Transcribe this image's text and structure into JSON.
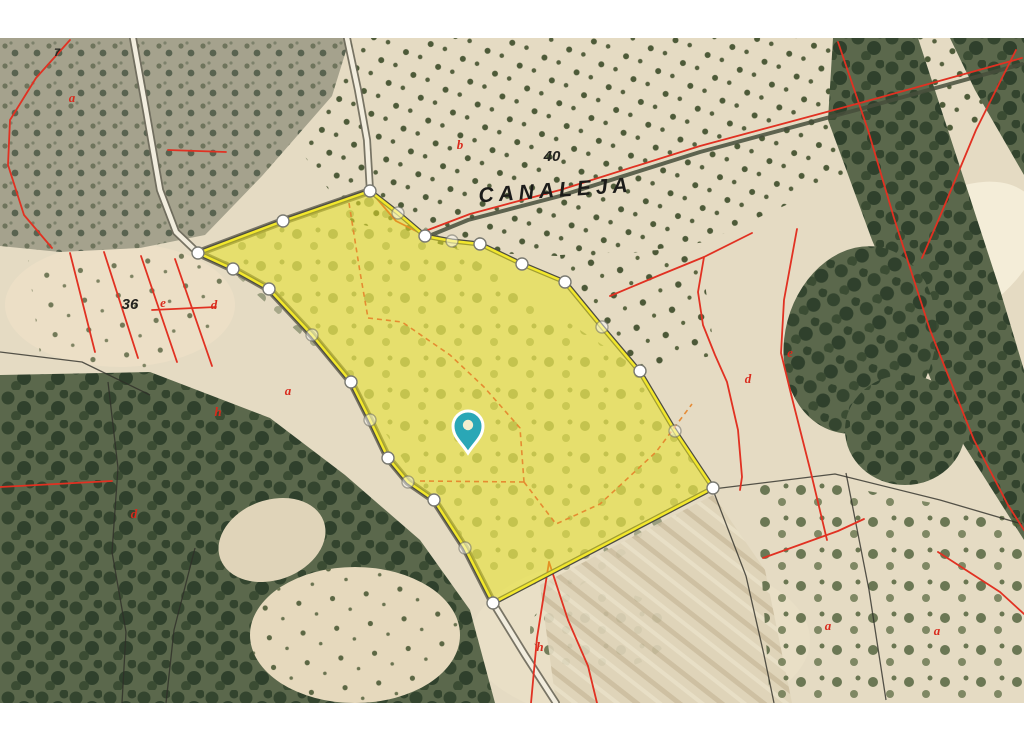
{
  "map": {
    "type_label": "aerial-cadastral-parcel-map",
    "colors": {
      "base": "#e5dbc3",
      "red_line": "#e13122",
      "orange_line": "#e5872e",
      "black_line": "#2e2e28",
      "track": "#474e3b",
      "road_casing": "#6b685a",
      "road_fill": "#f2edde",
      "parcel_fill": "#e8e226",
      "parcel_edge": "#f2e72c",
      "parcel_outline": "#4c4c41",
      "pin": "#2aa7b6",
      "pin_hole": "#f3efcf",
      "label_black": "#1c1c1a",
      "label_red": "#d92a1c"
    },
    "labels": {
      "toponym": {
        "text": "CANALEJA",
        "x": 556,
        "y": 197,
        "rotate": -4
      },
      "numbers": [
        {
          "text": "40",
          "x": 552,
          "y": 161
        },
        {
          "text": "36",
          "x": 130,
          "y": 309
        },
        {
          "text": "7",
          "x": 57,
          "y": 56
        }
      ],
      "letters": [
        {
          "text": "a",
          "x": 72,
          "y": 102
        },
        {
          "text": "b",
          "x": 460,
          "y": 149
        },
        {
          "text": "e",
          "x": 163,
          "y": 307
        },
        {
          "text": "d",
          "x": 214,
          "y": 309
        },
        {
          "text": "h",
          "x": 218,
          "y": 416
        },
        {
          "text": "a",
          "x": 288,
          "y": 395
        },
        {
          "text": "d",
          "x": 134,
          "y": 518
        },
        {
          "text": "h",
          "x": 540,
          "y": 651
        },
        {
          "text": "d",
          "x": 748,
          "y": 383
        },
        {
          "text": "e",
          "x": 790,
          "y": 357
        },
        {
          "text": "a",
          "x": 828,
          "y": 630
        },
        {
          "text": "a",
          "x": 937,
          "y": 635
        }
      ]
    },
    "roads": [
      {
        "kind": "path",
        "points": "133,38 146,110 160,190 176,232 198,253 233,269 269,289 312,335 351,382 370,420 388,458 408,482 434,500 465,548 493,603 525,655 556,703"
      },
      {
        "kind": "path",
        "points": "347,38 358,90 367,140 370,191 283,221 198,253"
      },
      {
        "kind": "track",
        "points": "1022,64 860,109 700,152 560,196 468,220 424,238"
      }
    ],
    "red_lines": [
      {
        "points": "1022,58 860,103 700,146 560,190 470,214 420,233 396,221 372,193"
      },
      {
        "points": "70,40 36,78 10,120 8,165 24,215 52,248"
      },
      {
        "points": "70,253 95,352"
      },
      {
        "points": "104,252 138,358"
      },
      {
        "points": "141,256 177,362"
      },
      {
        "points": "175,259 212,366"
      },
      {
        "points": "152,310 216,307"
      },
      {
        "points": "168,150 226,152"
      },
      {
        "points": "0,487 112,481"
      },
      {
        "points": "549,562 537,638 531,703"
      },
      {
        "points": "549,562 568,620 588,666 597,703"
      },
      {
        "points": "763,558 838,531 864,519"
      },
      {
        "points": "938,552 1000,592 1024,614"
      },
      {
        "points": "752,233 704,257 698,292 703,325 715,355 727,382 738,430 742,477 740,490"
      },
      {
        "points": "797,229 784,300 781,353 791,394 811,473 827,540"
      },
      {
        "points": "610,296 660,275 704,257"
      },
      {
        "points": "838,42 868,130 894,218 930,330 974,440 1008,505 1024,530"
      },
      {
        "points": "1016,50 976,130 941,214 922,258"
      }
    ],
    "orange_lines": [
      {
        "points": "349,203 360,272 368,318"
      },
      {
        "points": "368,318 402,322 450,355 484,387 520,428 524,482"
      },
      {
        "points": "420,481 524,482"
      },
      {
        "points": "524,482 556,524 600,504 656,452 692,404"
      }
    ],
    "black_lines": [
      {
        "points": "713,489 835,474 940,500 1022,524"
      },
      {
        "points": "713,490 746,576 764,655 774,703"
      },
      {
        "points": "846,473 869,590 886,700"
      },
      {
        "points": "108,382 118,468 112,552 126,632 122,703"
      },
      {
        "points": "195,548 174,630 166,703"
      },
      {
        "points": "0,352 82,362 150,395"
      }
    ],
    "parcel": {
      "points": "198,253 283,221 370,191 398,213 425,236 452,241 480,244 522,264 565,282 602,327 640,372 675,431 713,488 493,603 465,548 434,500 408,482 388,458 370,420 351,382 312,335 269,289 233,269",
      "fill_opacity": 0.55,
      "vertices": [
        {
          "x": 198,
          "y": 253,
          "solid": true
        },
        {
          "x": 283,
          "y": 221,
          "solid": true
        },
        {
          "x": 370,
          "y": 191,
          "solid": true
        },
        {
          "x": 398,
          "y": 213,
          "solid": false
        },
        {
          "x": 425,
          "y": 236,
          "solid": true
        },
        {
          "x": 452,
          "y": 241,
          "solid": false
        },
        {
          "x": 480,
          "y": 244,
          "solid": true
        },
        {
          "x": 522,
          "y": 264,
          "solid": true
        },
        {
          "x": 565,
          "y": 282,
          "solid": true
        },
        {
          "x": 602,
          "y": 327,
          "solid": false
        },
        {
          "x": 640,
          "y": 371,
          "solid": true
        },
        {
          "x": 675,
          "y": 431,
          "solid": false
        },
        {
          "x": 713,
          "y": 488,
          "solid": true
        },
        {
          "x": 493,
          "y": 603,
          "solid": true
        },
        {
          "x": 465,
          "y": 548,
          "solid": false
        },
        {
          "x": 434,
          "y": 500,
          "solid": true
        },
        {
          "x": 408,
          "y": 482,
          "solid": false
        },
        {
          "x": 388,
          "y": 458,
          "solid": true
        },
        {
          "x": 370,
          "y": 420,
          "solid": false
        },
        {
          "x": 351,
          "y": 382,
          "solid": true
        },
        {
          "x": 312,
          "y": 335,
          "solid": false
        },
        {
          "x": 269,
          "y": 289,
          "solid": true
        },
        {
          "x": 233,
          "y": 269,
          "solid": true
        }
      ]
    },
    "pin": {
      "x": 468,
      "y": 433
    }
  }
}
